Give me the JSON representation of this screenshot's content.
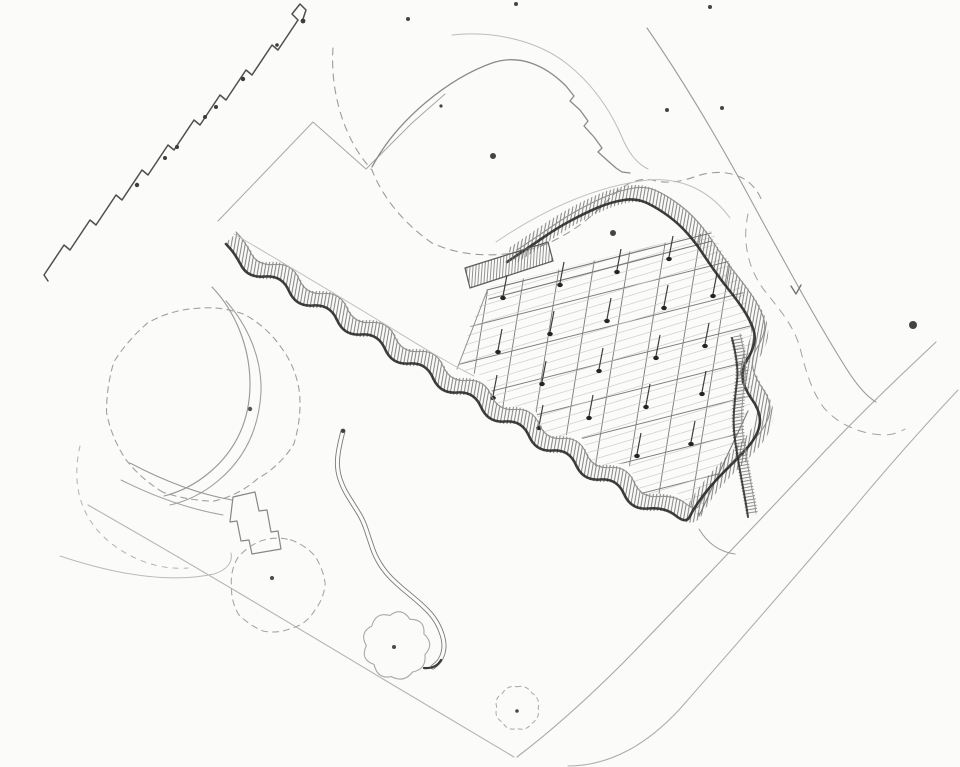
{
  "document": {
    "title": "Hand-drawn landscape site plan sketch",
    "media": "pencil on white paper",
    "visible_text": []
  },
  "palette": {
    "paper": "#fbfbf9",
    "pencil_dark": "#262626",
    "pencil": "#6b6b6b",
    "pencil_light": "#9a9a9a",
    "pencil_faint": "#bcbcbc"
  },
  "canvas": {
    "width": 960,
    "height": 767,
    "paper": "#fbfbf9"
  },
  "sketch": {
    "layers": [
      {
        "name": "site-boundary-left",
        "kind": "path",
        "d": "M88,505 C188,562 288,622 388,682 C432,708 478,736 514,757",
        "stroke": "#b4b4b4",
        "w": 1.1
      },
      {
        "name": "road-edge-upper",
        "kind": "path",
        "d": "M936,342 C902,374 866,408 826,450 C760,520 692,592 624,662 C586,700 550,732 517,757",
        "stroke": "#a8a8a8",
        "w": 1.1
      },
      {
        "name": "road-edge-lower",
        "kind": "path",
        "d": "M958,390 C926,424 892,462 852,510 C798,574 740,640 686,702 C650,744 610,766 568,766",
        "stroke": "#adadad",
        "w": 1.05
      },
      {
        "name": "site-boundary-topright",
        "kind": "path",
        "d": "M647,28 C676,70 708,122 740,180 C776,246 812,314 846,368 C856,384 866,396 876,402",
        "stroke": "#9c9c9c",
        "w": 1.1
      },
      {
        "name": "terraced-building-outline",
        "kind": "path",
        "d": "M48,281 L44,275 L64,245 L70,250 L90,220 L96,225 L116,195 L122,200 L142,170 L148,175 L168,145 L174,150 L194,120 L200,125 L220,95 L226,100 L246,70 L252,75 L272,45 L278,50 L298,20 L292,14 L300,4 L306,10 L302,22",
        "stroke": "#4f4f4f",
        "w": 1.5
      },
      {
        "name": "terraced-building-dots",
        "kind": "dots",
        "fill": "#3c3c3c",
        "pts": [
          [
            137,
            185,
            2.2
          ],
          [
            165,
            158,
            2
          ],
          [
            177,
            147,
            2
          ],
          [
            205,
            117,
            2
          ],
          [
            216,
            107,
            2
          ],
          [
            243,
            79,
            2.2
          ],
          [
            277,
            45,
            1.8
          ],
          [
            303,
            21,
            2.4
          ]
        ]
      },
      {
        "name": "plot-corner-lines",
        "kind": "path",
        "d": "M218,221 L313,122 M313,122 L366,169 L412,123 L445,94",
        "stroke": "#a6a6a6",
        "w": 1
      },
      {
        "name": "big-tree-arc-outer",
        "kind": "path",
        "d": "M452,35 C498,30 540,43 566,63 C592,83 610,110 621,135 C628,152 636,163 648,169",
        "stroke": "#bcbcbc",
        "w": 1
      },
      {
        "name": "big-tree-arc",
        "kind": "path",
        "d": "M372,167 C398,118 450,78 492,63 C518,54 544,64 566,86 L574,96 L570,101 L580,110 L588,121 L584,126 L594,137 L602,148 L598,152 L608,161 L616,168 L622,172 L630,173",
        "stroke": "#8a8a8a",
        "w": 1.3
      },
      {
        "name": "big-tree-dashed-outline",
        "kind": "path",
        "d": "M333,48 C330,92 344,140 372,170 C382,196 402,222 432,243 C462,257 498,258 532,249 C560,241 588,222 610,198 C622,186 636,177 652,180 C666,184 680,182 694,177 C710,171 730,170 746,180 C754,186 760,194 762,202",
        "stroke": "#9c9c9c",
        "w": 1.1,
        "dash": "7 6"
      },
      {
        "name": "dashed-curve-east",
        "kind": "path",
        "d": "M748,214 C742,242 748,268 764,290 C780,310 794,326 800,348 C806,372 812,392 824,408 C840,426 862,434 884,435 C892,435 900,432 905,429",
        "stroke": "#a2a2a2",
        "w": 1,
        "dash": "8 7"
      },
      {
        "name": "left-tree-dashed-circle",
        "kind": "blob",
        "cx": 204,
        "cy": 403,
        "r": 96,
        "lobes": 12,
        "scallop": 1.03,
        "wobble": 0.07,
        "seed": 2,
        "stroke": "#a0a0a0",
        "w": 1.1,
        "dash": "6 5"
      },
      {
        "name": "left-tree-dot",
        "kind": "dots",
        "fill": "#555555",
        "pts": [
          [
            250,
            409,
            2.2
          ]
        ]
      },
      {
        "name": "left-tree-sw-dashed-arc",
        "kind": "path",
        "d": "M80,446 C70,490 84,522 112,544 C136,562 162,570 188,568",
        "stroke": "#b2b2b2",
        "w": 1,
        "dash": "5 6"
      },
      {
        "name": "garden-band-arc-1",
        "kind": "path",
        "d": "M212,287 C236,312 250,348 250,384 C250,420 236,450 210,472 C196,484 180,492 164,496",
        "stroke": "#9a9a9a",
        "w": 1.15
      },
      {
        "name": "garden-band-arc-2",
        "kind": "path",
        "d": "M226,301 C248,326 262,358 261,392 C259,428 245,458 219,480 C205,492 188,501 170,505",
        "stroke": "#9e9e9e",
        "w": 1.1
      },
      {
        "name": "garden-band-arc-3",
        "kind": "path",
        "d": "M130,463 C164,481 198,494 232,500",
        "stroke": "#9a9a9a",
        "w": 1.1
      },
      {
        "name": "garden-band-arc-4",
        "kind": "path",
        "d": "M121,480 C155,497 189,509 223,515",
        "stroke": "#a2a2a2",
        "w": 1.05
      },
      {
        "name": "garden-steps",
        "kind": "path",
        "d": "M233,497 L255,492 L259,511 L267,510 L271,532 L278,531 L281,549 L252,554 L249,540 L241,541 L237,521 L230,522 Z",
        "stroke": "#878787",
        "w": 1.2
      },
      {
        "name": "lower-left-faint-arc",
        "kind": "path",
        "d": "M60,556 C114,574 168,584 214,574 C227,570 233,562 231,553",
        "stroke": "#bababa",
        "w": 1
      },
      {
        "name": "round-tree-dashed",
        "kind": "blob",
        "cx": 277,
        "cy": 585,
        "r": 47,
        "lobes": 10,
        "scallop": 1.04,
        "wobble": 0.08,
        "seed": 5,
        "stroke": "#a4a4a4",
        "w": 1.05,
        "dash": "6 5"
      },
      {
        "name": "round-tree-dot",
        "kind": "dots",
        "fill": "#4a4a4a",
        "pts": [
          [
            272,
            578,
            2
          ]
        ]
      },
      {
        "name": "cloud-tree",
        "kind": "blob",
        "cx": 396,
        "cy": 645,
        "r": 31,
        "lobes": 9,
        "scallop": 1.26,
        "wobble": 0.12,
        "seed": 8,
        "stroke": "#a8a8a8",
        "w": 1.1
      },
      {
        "name": "cloud-tree-dot",
        "kind": "dots",
        "fill": "#4a4a4a",
        "pts": [
          [
            394,
            647,
            2
          ]
        ]
      },
      {
        "name": "small-tree-dashed",
        "kind": "blob",
        "cx": 517,
        "cy": 708,
        "r": 21,
        "lobes": 8,
        "scallop": 1.2,
        "wobble": 0.1,
        "seed": 11,
        "stroke": "#a8a8a8",
        "w": 1,
        "dash": "4 4"
      },
      {
        "name": "small-tree-dot",
        "kind": "dots",
        "fill": "#4a4a4a",
        "pts": [
          [
            517,
            711,
            1.8
          ]
        ]
      },
      {
        "name": "serpentine-path",
        "kind": "spath",
        "anchors": [
          [
            343,
            431
          ],
          [
            338,
            450
          ],
          [
            337,
            470
          ],
          [
            343,
            488
          ],
          [
            353,
            504
          ],
          [
            363,
            520
          ],
          [
            369,
            538
          ],
          [
            375,
            556
          ],
          [
            385,
            572
          ],
          [
            397,
            584
          ],
          [
            409,
            594
          ],
          [
            421,
            604
          ],
          [
            433,
            616
          ],
          [
            441,
            630
          ],
          [
            445,
            646
          ],
          [
            441,
            660
          ],
          [
            433,
            667
          ]
        ],
        "stroke": "#7a7a7a",
        "w": 5,
        "paper": "#fbfbf9"
      },
      {
        "name": "canopy-grid",
        "kind": "grid",
        "clip": [
          [
            490,
            287
          ],
          [
            712,
            231
          ],
          [
            728,
            260
          ],
          [
            744,
            294
          ],
          [
            754,
            330
          ],
          [
            748,
            358
          ],
          [
            753,
            390
          ],
          [
            748,
            412
          ],
          [
            735,
            441
          ],
          [
            717,
            478
          ],
          [
            699,
            516
          ],
          [
            676,
            492
          ],
          [
            642,
            495
          ],
          [
            628,
            463
          ],
          [
            594,
            466
          ],
          [
            580,
            434
          ],
          [
            546,
            437
          ],
          [
            533,
            405
          ],
          [
            499,
            408
          ],
          [
            485,
            376
          ],
          [
            458,
            370
          ],
          [
            470,
            327
          ],
          [
            482,
            300
          ]
        ],
        "families": [
          {
            "mode": "y=sx+c",
            "s": -0.252,
            "c0": 410,
            "c1": 700,
            "step": 35,
            "x0": 445,
            "x1": 775,
            "stroke": "#7e7e7e",
            "w": 0.95
          },
          {
            "mode": "x=k-sy",
            "s": 0.16,
            "c0": 500,
            "c1": 792,
            "step": 34,
            "y0": 205,
            "y1": 545,
            "stroke": "#7e7e7e",
            "w": 0.95
          },
          {
            "mode": "y=sx+c",
            "s": -0.3,
            "c0": 425,
            "c1": 735,
            "step": 8.5,
            "x0": 445,
            "x1": 775,
            "stroke": "#c6c6c6",
            "w": 0.7,
            "opacity": 0.85
          }
        ]
      },
      {
        "name": "canopy-top-edge",
        "kind": "path",
        "d": "M487,290 L711,233 M489,299 L712,241",
        "stroke": "#787878",
        "w": 1.15
      },
      {
        "name": "canopy-left-edge",
        "kind": "path",
        "d": "M487,291 L457,369",
        "stroke": "#8e8e8e",
        "w": 1
      },
      {
        "name": "canopy-se-edge",
        "kind": "path",
        "d": "M748,411 L699,516",
        "stroke": "#848484",
        "w": 1.2
      },
      {
        "name": "canopy-columns",
        "kind": "columns",
        "tick": [
          4,
          -23
        ],
        "stroke": "#3e3e3e",
        "fill": "#242424",
        "pts": [
          [
            505,
            300
          ],
          [
            560,
            286
          ],
          [
            615,
            272
          ],
          [
            670,
            258
          ],
          [
            497,
            350
          ],
          [
            552,
            336
          ],
          [
            607,
            322
          ],
          [
            662,
            308
          ],
          [
            714,
            295
          ],
          [
            492,
            396
          ],
          [
            544,
            386
          ],
          [
            599,
            372
          ],
          [
            654,
            358
          ],
          [
            706,
            345
          ],
          [
            538,
            426
          ],
          [
            591,
            420
          ],
          [
            646,
            408
          ],
          [
            700,
            394
          ],
          [
            638,
            455
          ],
          [
            690,
            442
          ]
        ]
      },
      {
        "name": "serpentine-wall",
        "kind": "band",
        "anchors": [
          [
            512,
            256
          ],
          [
            536,
            240
          ],
          [
            562,
            222
          ],
          [
            590,
            207
          ],
          [
            616,
            196
          ],
          [
            642,
            192
          ],
          [
            664,
            203
          ],
          [
            684,
            218
          ],
          [
            700,
            236
          ],
          [
            712,
            254
          ],
          [
            726,
            274
          ],
          [
            742,
            294
          ],
          [
            754,
            312
          ],
          [
            761,
            330
          ],
          [
            757,
            346
          ],
          [
            748,
            360
          ],
          [
            747,
            374
          ],
          [
            753,
            388
          ],
          [
            763,
            402
          ],
          [
            766,
            418
          ],
          [
            759,
            434
          ],
          [
            747,
            448
          ],
          [
            735,
            460
          ],
          [
            721,
            474
          ],
          [
            709,
            488
          ],
          [
            698,
            504
          ],
          [
            691,
            518
          ],
          [
            670,
            501
          ],
          [
            636,
            504
          ],
          [
            622,
            472
          ],
          [
            588,
            475
          ],
          [
            574,
            443
          ],
          [
            541,
            446
          ],
          [
            527,
            414
          ],
          [
            493,
            417
          ],
          [
            479,
            385
          ],
          [
            445,
            388
          ],
          [
            431,
            356
          ],
          [
            397,
            359
          ],
          [
            383,
            327
          ],
          [
            349,
            330
          ],
          [
            335,
            298
          ],
          [
            301,
            301
          ],
          [
            287,
            269
          ],
          [
            253,
            272
          ],
          [
            240,
            248
          ],
          [
            231,
            238
          ]
        ],
        "width": 17,
        "hatch": {
          "angle": 10,
          "gap": 3.4,
          "stroke": "#696969",
          "w": 0.85
        },
        "edge_dark": {
          "dx": -5,
          "dy": 6,
          "stroke": "#262626",
          "w": 2.6
        },
        "edge_light": {
          "dx": 5,
          "dy": -6,
          "stroke": "#8f8f8f",
          "w": 1.1
        }
      },
      {
        "name": "wall-offset-faint-nw",
        "kind": "path",
        "d": "M234,234 C282,262 330,291 378,320 C412,341 446,362 474,376",
        "stroke": "#c0c0c0",
        "w": 1
      },
      {
        "name": "wall-offset-faint-top",
        "kind": "path",
        "d": "M496,242 C546,208 598,186 648,180 C688,177 714,196 730,218",
        "stroke": "#c0c0c0",
        "w": 1
      },
      {
        "name": "entry-bar",
        "kind": "bar",
        "poly": [
          [
            465,
            268
          ],
          [
            548,
            242
          ],
          [
            553,
            261
          ],
          [
            470,
            288
          ]
        ],
        "hatch": {
          "angle": 4,
          "gap": 3,
          "stroke": "#777777",
          "w": 0.8
        },
        "stroke": "#5a5a5a",
        "w": 1.2
      },
      {
        "name": "east-bar",
        "kind": "band",
        "anchors": [
          [
            736,
            336
          ],
          [
            743,
            364
          ],
          [
            739,
            394
          ],
          [
            737,
            424
          ],
          [
            741,
            452
          ],
          [
            746,
            480
          ],
          [
            750,
            502
          ],
          [
            752,
            515
          ]
        ],
        "width": 12,
        "hatch": {
          "angle": 80,
          "gap": 3.2,
          "stroke": "#6f6f6f",
          "w": 0.8
        },
        "edge_dark": {
          "dx": -4,
          "dy": 2,
          "stroke": "#2e2e2e",
          "w": 2
        },
        "edge_light": {
          "dx": 4,
          "dy": -2,
          "stroke": "#979797",
          "w": 1
        }
      },
      {
        "name": "tip-curl",
        "kind": "path",
        "d": "M699,529 C708,544 720,552 735,554",
        "stroke": "#9a9a9a",
        "w": 1
      },
      {
        "name": "check-mark",
        "kind": "path",
        "d": "M791,286 L796,294 L801,285",
        "stroke": "#6f6f6f",
        "w": 1.3
      },
      {
        "name": "scatter-specks",
        "kind": "dots",
        "fill": "#444444",
        "pts": [
          [
            408,
            19,
            2
          ],
          [
            516,
            4,
            2
          ],
          [
            710,
            7,
            2
          ],
          [
            667,
            110,
            2
          ],
          [
            722,
            108,
            2
          ],
          [
            493,
            156,
            3
          ],
          [
            441,
            106,
            1.6
          ],
          [
            613,
            233,
            3
          ],
          [
            913,
            325,
            4
          ]
        ]
      }
    ]
  }
}
